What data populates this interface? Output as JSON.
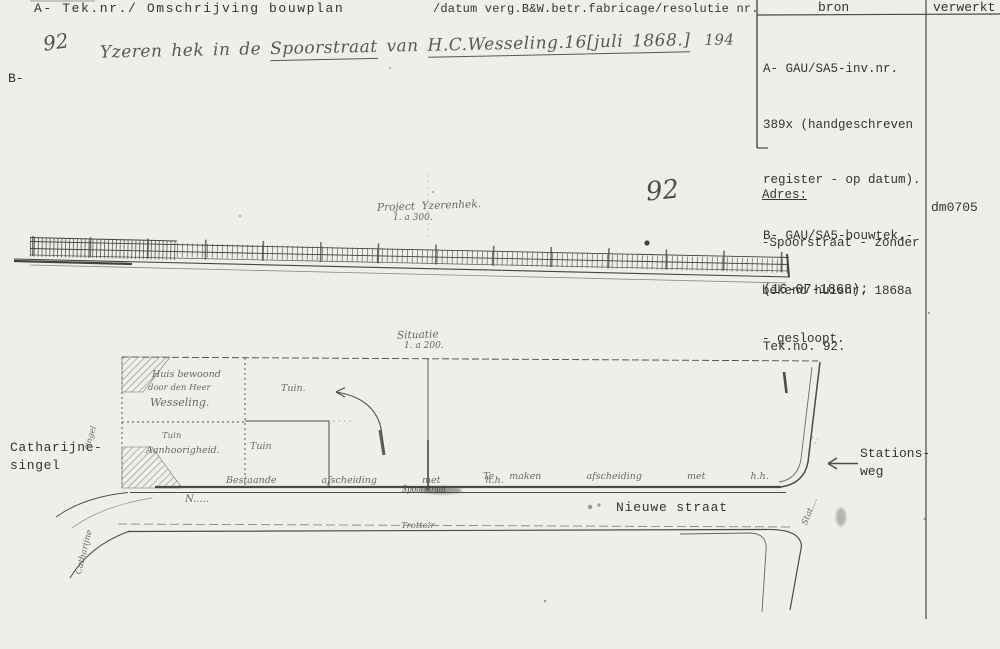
{
  "header": {
    "col1_label": "A- Tek.nr./ Omschrijving bouwplan",
    "col2_label": "/datum verg.B&W.betr.fabricage/resolutie nr.",
    "bron_label": "bron",
    "verwerkt_label": "verwerkt",
    "b_label": "B-",
    "verwerkt_code": "dm0705"
  },
  "handwritten_entry": {
    "teknr": "92",
    "parts": {
      "p1": "Yzeren hek in de ",
      "p2": "Spoorstraat",
      "p3": " van ",
      "p4": "H.C.Wesseling.16[juli 1868.]",
      "p5": "194"
    }
  },
  "bron": {
    "lines": {
      "l1": "A- GAU/SA5-inv.nr.",
      "l2": "389x (handgeschreven",
      "l3": "register - op datum).",
      "l4": "B- GAU/SA5-bouwtek.-",
      "l5": "(16-07-1868);",
      "l6": "Tek.no. 92."
    }
  },
  "adres": {
    "title": "Adres:",
    "l1": "-Spoorstraat - zonder",
    "l2": "bekend huisnr. 1868a",
    "l3": "- gesloopt."
  },
  "drawing": {
    "sheet_number": "92",
    "elevation_title": "Project  Yzerenhek.",
    "elevation_scale": "1. a 300.",
    "plan_title": "Situatie",
    "plan_scale": "1. a 200.",
    "parcel": {
      "huis1": "Huis bewoond",
      "huis2": "door den Heer",
      "huis3": "Wesseling.",
      "links1": "Tuin",
      "links2": "Aanhoorigheid.",
      "tuin_mid": "Tuin.",
      "tuin_klein": "Tuin",
      "fence_left": "Bestaande   afscheiding   met   h.h.",
      "fence_right": "Te maken   afscheiding   met   h.h.",
      "gate": "Spoorstraat"
    },
    "streets": {
      "catharijnesingel_1": "Catharijne-",
      "catharijnesingel_2": "singel",
      "stationsweg_1": "Stations-",
      "stationsweg_2": "weg",
      "nieuwe_straat": "Nieuwe straat",
      "catharijne_hand": "Catharijne",
      "singel_hand": "singel",
      "stations_hand": "Stat....",
      "n_scribble": "N.....",
      "kerb_scribble": "Trottoir"
    }
  }
}
